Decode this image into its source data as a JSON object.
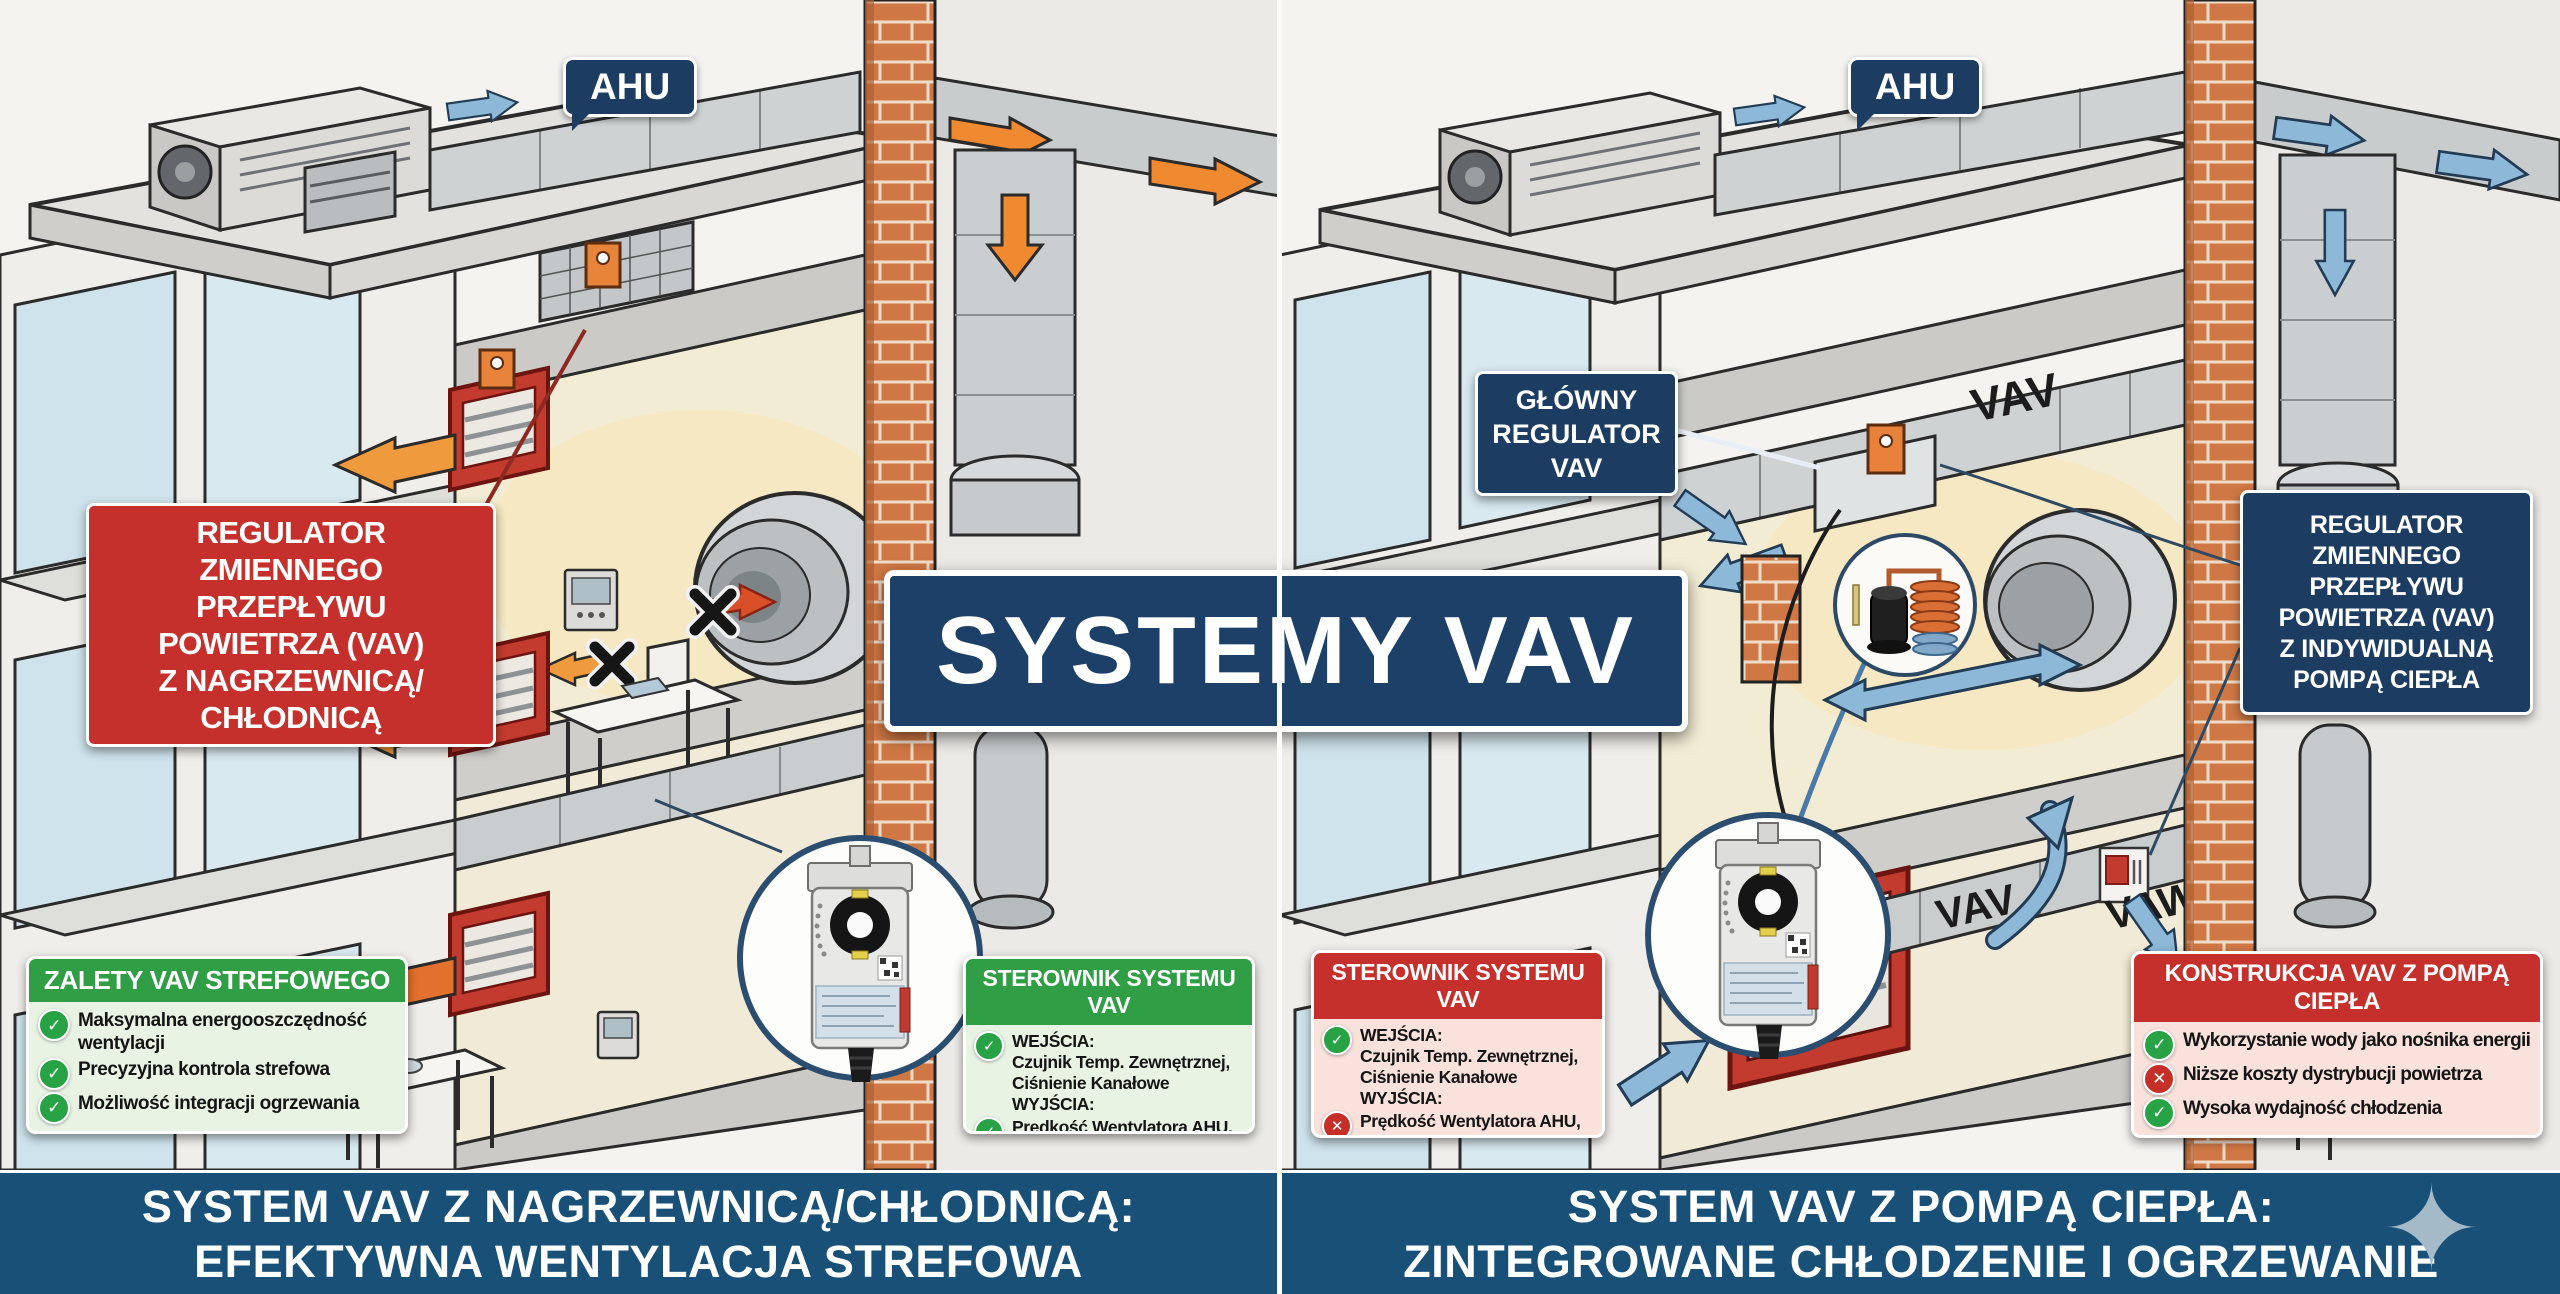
{
  "center_title": "SYSTEMY VAV",
  "icons": {
    "check": "✓",
    "cross": "✕",
    "sparkle": "✦"
  },
  "colors": {
    "navy_label": "#1c3d61",
    "red_label": "#c5302c",
    "green_header": "#2f9e45",
    "light_green_body": "#e9f3e4",
    "pink_body": "#f9e2dc",
    "banner_navy": "#185078",
    "orange_arrow": "#ef9a3c",
    "blue_arrow": "#8db8d8",
    "brick": "#d07845"
  },
  "panels": {
    "left": {
      "ahu": "AHU",
      "callout_vav_coil": "REGULATOR ZMIENNEGO PRZEPŁYWU POWIETRZA (VAV) Z NAGRZEWNICĄ/ CHŁODNICĄ",
      "callout_vav_coil_lines": [
        "REGULATOR",
        "ZMIENNEGO",
        "PRZEPŁYWU",
        "POWIETRZA (VAV)",
        "Z NAGRZEWNICĄ/",
        "CHŁODNICĄ"
      ],
      "advantages": {
        "title": "ZALETY VAV STREFOWEGO",
        "items": [
          {
            "icon": "check",
            "text": "Maksymalna energooszczędność wentylacji"
          },
          {
            "icon": "check",
            "text": "Precyzyjna kontrola strefowa"
          },
          {
            "icon": "check",
            "text": "Możliwość integracji ogrzewania"
          }
        ]
      },
      "controller": {
        "title": "STEROWNIK SYSTEMU VAV",
        "rows": [
          {
            "icon": "check",
            "text": "WEJŚCIA:\nCzujnik Temp. Zewnętrznej,\nCiśnienie Kanałowe\nWYJŚCIA:"
          },
          {
            "icon": "check",
            "text": "Prędkość Wentylatora AHU,\nSiłownik Przepustnicy VAV"
          }
        ]
      },
      "banner": {
        "line1": "SYSTEM VAV Z NAGRZEWNICĄ/CHŁODNICĄ:",
        "line2": "EFEKTYWNA WENTYLACJA STREFOWA"
      }
    },
    "right": {
      "ahu": "AHU",
      "main_regulator": "GŁÓWNY REGULATOR VAV",
      "main_regulator_lines": [
        "GŁÓWNY",
        "REGULATOR",
        "VAV"
      ],
      "callout_vav_hp": "REGULATOR ZMIENNEGO PRZEPŁYWU POWIETRZA (VAV) Z INDYWIDUALNĄ POMPĄ CIEPŁA",
      "callout_vav_hp_lines": [
        "REGULATOR",
        "ZMIENNEGO",
        "PRZEPŁYWU",
        "POWIETRZA (VAV)",
        "Z INDYWIDUALNĄ",
        "POMPĄ CIEPŁA"
      ],
      "duct_labels": {
        "main": "VAV",
        "lower": "VAV",
        "wall": "VAW"
      },
      "controller": {
        "title": "STEROWNIK SYSTEMU VAV",
        "rows": [
          {
            "icon": "check",
            "text": "WEJŚCIA:\nCzujnik Temp. Zewnętrznej,\nCiśnienie Kanałowe\nWYJŚCIA:"
          },
          {
            "icon": "cross",
            "text": "Prędkość Wentylatora AHU,\nSiłownik Przepustnicy VAV"
          }
        ]
      },
      "construction": {
        "title": "KONSTRUKCJA VAV Z POMPĄ CIEPŁA",
        "items": [
          {
            "icon": "check",
            "text": "Wykorzystanie wody jako nośnika energii"
          },
          {
            "icon": "cross",
            "text": "Niższe koszty dystrybucji powietrza"
          },
          {
            "icon": "check",
            "text": "Wysoka wydajność chłodzenia"
          }
        ]
      },
      "banner": {
        "line1": "SYSTEM VAV Z POMPĄ CIEPŁA:",
        "line2": "ZINTEGROWANE CHŁODZENIE I OGRZEWANIE"
      }
    }
  }
}
